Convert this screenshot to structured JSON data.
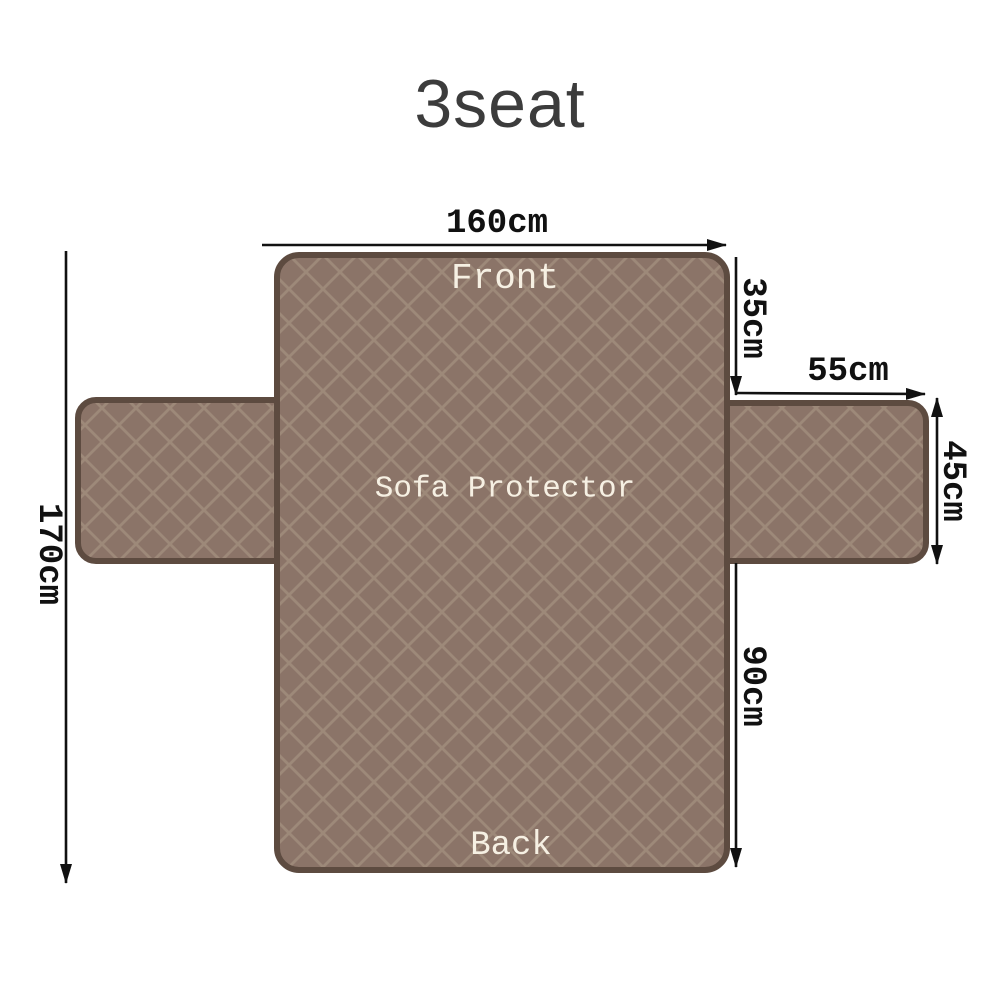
{
  "title": "3seat",
  "diagram": {
    "front_label": "Front",
    "center_label": "Sofa Protector",
    "back_label": "Back",
    "dimensions": {
      "width_total": "160cm",
      "front_depth": "35cm",
      "armrest_length": "55cm",
      "armrest_width": "45cm",
      "back_depth": "90cm",
      "length_total": "170cm"
    }
  },
  "colors": {
    "background": "#ffffff",
    "title_ink": "#3c3c3c",
    "dimension_ink": "#111111",
    "fabric_base": "#8b7468",
    "fabric_lattice": "#a3907f",
    "fabric_border": "#5d4b40",
    "fabric_text": "#f6f0e3"
  }
}
